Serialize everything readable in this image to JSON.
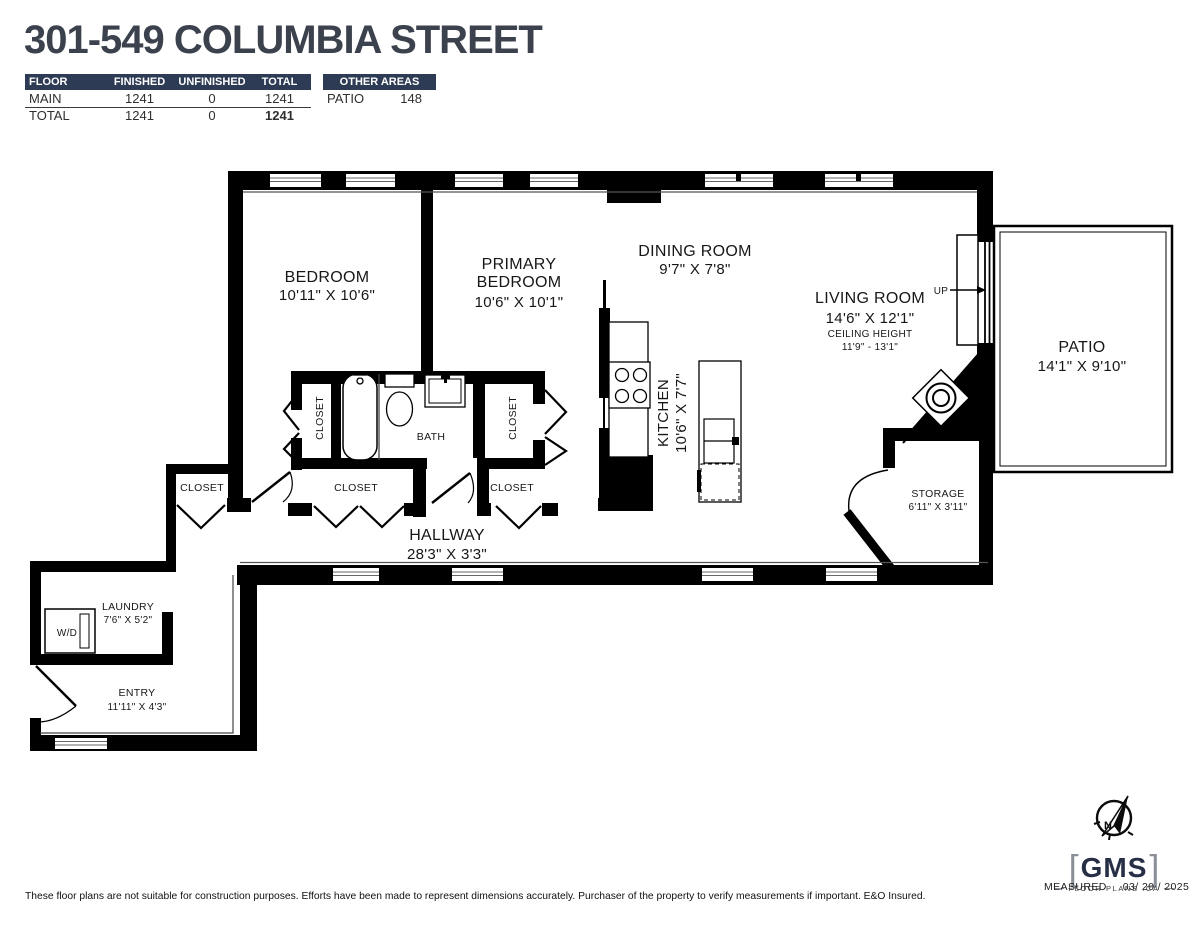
{
  "colors": {
    "navy": "#2d3b54",
    "wall": "#000000",
    "title": "#3c424d"
  },
  "header": {
    "title": "301-549 COLUMBIA STREET",
    "area_table": {
      "columns": [
        "FLOOR",
        "FINISHED",
        "UNFINISHED",
        "TOTAL"
      ],
      "rows": [
        {
          "floor": "MAIN",
          "finished": "1241",
          "unfinished": "0",
          "total": "1241"
        },
        {
          "floor": "TOTAL",
          "finished": "1241",
          "unfinished": "0",
          "total": "1241"
        }
      ]
    },
    "other_areas": {
      "title": "OTHER AREAS",
      "rows": [
        {
          "name": "PATIO",
          "value": "148"
        }
      ]
    }
  },
  "rooms": {
    "bedroom": {
      "name": "BEDROOM",
      "dims": "10'11\" X 10'6\""
    },
    "primary_bedroom": {
      "name_line1": "PRIMARY",
      "name_line2": "BEDROOM",
      "dims": "10'6\" X 10'1\""
    },
    "dining_room": {
      "name": "DINING ROOM",
      "dims": "9'7\" X 7'8\""
    },
    "living_room": {
      "name": "LIVING ROOM",
      "dims": "14'6\" X 12'1\"",
      "ceiling_label": "CEILING HEIGHT",
      "ceiling_dims": "11'9\" - 13'1\""
    },
    "kitchen": {
      "name": "KITCHEN",
      "dims": "10'6\" X 7'7\""
    },
    "patio": {
      "name": "PATIO",
      "dims": "14'1\" X 9'10\""
    },
    "storage": {
      "name": "STORAGE",
      "dims": "6'11\" X 3'11\""
    },
    "hallway": {
      "name": "HALLWAY",
      "dims": "28'3\" X 3'3\""
    },
    "laundry": {
      "name": "LAUNDRY",
      "dims": "7'6\" X 5'2\""
    },
    "entry": {
      "name": "ENTRY",
      "dims": "11'11\" X 4'3\""
    },
    "closet": "CLOSET",
    "bath": "BATH",
    "washer_dryer": "W/D",
    "up": "UP"
  },
  "footer": {
    "disclaimer": "These floor plans are not suitable for construction purposes. Efforts have been made to represent dimensions accurately.  Purchaser of the property to verify measurements if important.  E&O Insured."
  },
  "branding": {
    "logo_text": "GMS",
    "logo_sub": "FLOOR PLANS .CA",
    "bracket_left": "[",
    "bracket_right": "]",
    "compass_letter": "N",
    "measured_label": "MEASURED",
    "measured_date": "03/ 20 / 2025"
  }
}
